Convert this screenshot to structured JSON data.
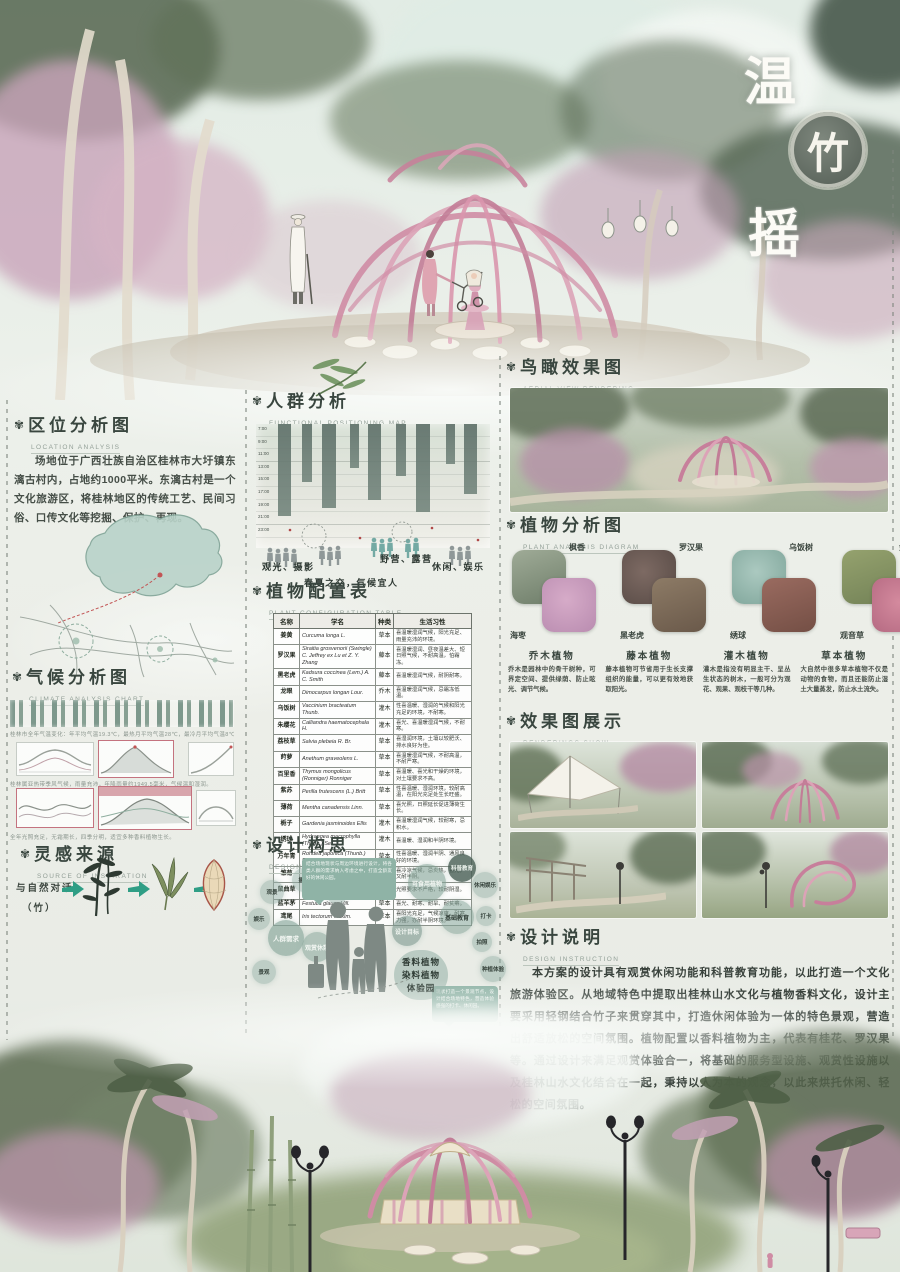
{
  "poster_title": {
    "char_top": "温",
    "char_badge": "竹",
    "char_bottom": "摇"
  },
  "sections": {
    "location": {
      "title": "区位分析图",
      "subtitle": "LOCATION ANALYSIS",
      "body": "场地位于广西壮族自治区桂林市大圩镇东漓古村内，占地约1000平米。东漓古村是一个文化旅游区，将桂林地区的传统工艺、民间习俗、口传文化等挖掘、保护、再现。"
    },
    "climate": {
      "title": "气候分析图",
      "subtitle": "CLIMATE ANALYSIS CHART",
      "caption_top": "桂林市全年气温变化：年平均气温19.3℃，最热月平均气温28℃，最冷月平均气温8℃。",
      "caption_mid": "桂林属亚热带季风气候，雨量充沛，年降雨量约1949.5毫米，气候温和湿润。",
      "caption_bottom": "全年光照充足，无霜期长，四季分明，适宜多种香料植物生长。"
    },
    "inspiration": {
      "title": "灵感来源",
      "subtitle": "SOURCE OF INSPIRATION",
      "label": "与自然对话",
      "sublabel": "（竹）"
    },
    "crowd": {
      "title": "人群分析",
      "subtitle": "FUNCTIONAL POSITIONING MAP",
      "times": [
        "7:00",
        "9:00",
        "11:00",
        "13:00",
        "15:00",
        "17:00",
        "19:00",
        "21:00",
        "23:00"
      ],
      "labels": [
        "观光、摄影",
        "春夏之交，气候宜人",
        "野营、露营",
        "休闲、娱乐"
      ]
    },
    "plant_table": {
      "title": "植物配置表",
      "subtitle": "PLANT CONFIGURATION TABLE",
      "headers": [
        "名称",
        "学名",
        "种类",
        "生活习性"
      ],
      "rows": [
        {
          "name": "姜黄",
          "latin": "Curcuma longa L.",
          "type": "草本",
          "habit": "喜温暖湿润气候，阳光充足、雨量充沛的环境。"
        },
        {
          "name": "罗汉果",
          "latin": "Siraitia grosvenorii (Swingle) C. Jeffrey ex Lu et Z. Y. Zhang",
          "type": "藤本",
          "habit": "喜温暖湿润、昼夜温差大、短日照气候，不耐高温，怕霜冻。"
        },
        {
          "name": "黑老虎",
          "latin": "Kadsura coccinea (Lem.) A. C. Smith",
          "type": "藤本",
          "habit": "喜温暖湿润气候，耐阴耐寒。"
        },
        {
          "name": "龙眼",
          "latin": "Dimocarpus longan Lour.",
          "type": "乔木",
          "habit": "喜温暖湿润气候，忌霜冻低温。"
        },
        {
          "name": "乌饭树",
          "latin": "Vaccinium bracteatum Thunb.",
          "type": "灌木",
          "habit": "性喜温暖、湿润的气候和阳光充足的环境，不耐寒。"
        },
        {
          "name": "朱缨花",
          "latin": "Calliandra haematocephala H.",
          "type": "灌木",
          "habit": "喜光、喜温暖湿润气候，不耐寒。"
        },
        {
          "name": "荔枝草",
          "latin": "Salvia plebeia R. Br.",
          "type": "草本",
          "habit": "喜湿润环境，土壤以较肥沃、排水良好为佳。"
        },
        {
          "name": "莳萝",
          "latin": "Anethum graveolens L.",
          "type": "草本",
          "habit": "喜温暖湿润气候，不耐高温，不耐严寒。"
        },
        {
          "name": "百里香",
          "latin": "Thymus mongolicus (Ronniger) Ronniger",
          "type": "草本",
          "habit": "喜温暖、喜光和干燥的环境，对土壤要求不高。"
        },
        {
          "name": "紫苏",
          "latin": "Perilla frutescens (L.) Britt",
          "type": "草本",
          "habit": "性喜温暖、湿润环境，较耐高温，在阳光充足处生长旺盛。"
        },
        {
          "name": "薄荷",
          "latin": "Mentha canadensis Linn.",
          "type": "草本",
          "habit": "喜光照，日照延长促进薄荷生长。"
        },
        {
          "name": "栀子",
          "latin": "Gardenia jasminoides Ellis",
          "type": "灌木",
          "habit": "喜温暖湿润气候，较耐寒，忌积水。"
        },
        {
          "name": "绣球",
          "latin": "Hydrangea macrophylla (Thunb.) Ser.",
          "type": "灌木",
          "habit": "喜温暖、湿润和半阴环境。"
        },
        {
          "name": "万年青",
          "latin": "Rohdea japonica (Thunb.) Roth",
          "type": "草本",
          "habit": "性喜温暖、湿润半阴、通风良好的环境。"
        },
        {
          "name": "雏菊",
          "latin": "Bellis perennis L.",
          "type": "草本",
          "habit": "喜冷凉气候，忌炎热，喜光，又耐半阴。"
        },
        {
          "name": "鼠曲草",
          "latin": "Pseudognaphalium affine (D. Don) Anderberg",
          "type": "草本",
          "habit": "光照要求不严格，较耐阴湿。"
        },
        {
          "name": "蓝羊茅",
          "latin": "Festuca glauca Vill.",
          "type": "草本",
          "habit": "喜光、耐寒、耐旱、耐贫瘠。"
        },
        {
          "name": "鸢尾",
          "latin": "Iris tectorum Maxim.",
          "type": "草本",
          "habit": "喜阳光充足，气候凉爽，耐寒力强，亦耐半阴环境。"
        }
      ]
    },
    "concept": {
      "title": "设计构思",
      "subtitle": "DESIGN CONCEPT",
      "bubbles": [
        "观景",
        "摄影",
        "停留",
        "娱乐",
        "人群需求",
        "观赏休憩",
        "景观",
        "可食用植物",
        "科普教育",
        "休闲娱乐",
        "基础教育",
        "打卡",
        "拍照",
        "种植体验",
        "设计目标"
      ],
      "speech_top": "结合场地现状与周边环境进行设计，将各类人群的需求纳入考虑之中，打造全龄友好的休闲公园。",
      "speech_right": "现状打造一个景观节点，设计结合场地特色，营造体验感强的打卡、休闲园。",
      "goal": [
        "香料植物",
        "染料植物",
        "体验园"
      ]
    },
    "aerial": {
      "title": "鸟瞰效果图",
      "subtitle": "AERIAL VIEW RENDERING"
    },
    "plant_analysis": {
      "title": "植物分析图",
      "subtitle": "PLANT ANALYSIS DIAGRAM",
      "pairs": [
        {
          "top": "枫香",
          "bottom": "海枣"
        },
        {
          "top": "罗汉果",
          "bottom": "黑老虎"
        },
        {
          "top": "乌饭树",
          "bottom": "绣球"
        },
        {
          "top": "金鸡菊",
          "bottom": "观音草"
        }
      ],
      "categories": [
        {
          "name": "乔木植物",
          "desc": "乔木是园林中的骨干树种，可界定空间、提供绿荫、防止眩光、调节气候。"
        },
        {
          "name": "藤本植物",
          "desc": "藤本植物可节省用于生长支撑组织的能量，可以更有效地获取阳光。"
        },
        {
          "name": "灌木植物",
          "desc": "灌木是指没有明显主干、呈丛生状态的树木，一般可分为观花、观果、观枝干等几种。"
        },
        {
          "name": "草本植物",
          "desc": "大自然中很多草本植物不仅是动物的食物，而且还能防止湿土大量蒸发，防止水土流失。"
        }
      ]
    },
    "renderings": {
      "title": "效果图展示",
      "subtitle": "RENDERINGS SHOW"
    },
    "description": {
      "title": "设计说明",
      "subtitle": "DESIGN INSTRUCTION",
      "body": "本方案的设计具有观赏休闲功能和科普教育功能，以此打造一个文化旅游体验区。从地域特色中提取出桂林山水文化与植物香料文化，设计主要采用轻钢结合竹子来贯穿其中，打造休闲体验为一体的特色景观，营造出舒适放松的空间氛围。植物配置以香料植物为主，代表有桂花、罗汉果等。通过设计来满足观赏体验合一，将基础的服务型设施、观赏性设施以及桂林山水文化结合在一起，秉持以人为本的观念，以此来烘托休闲、轻松的空间氛围。"
    }
  }
}
